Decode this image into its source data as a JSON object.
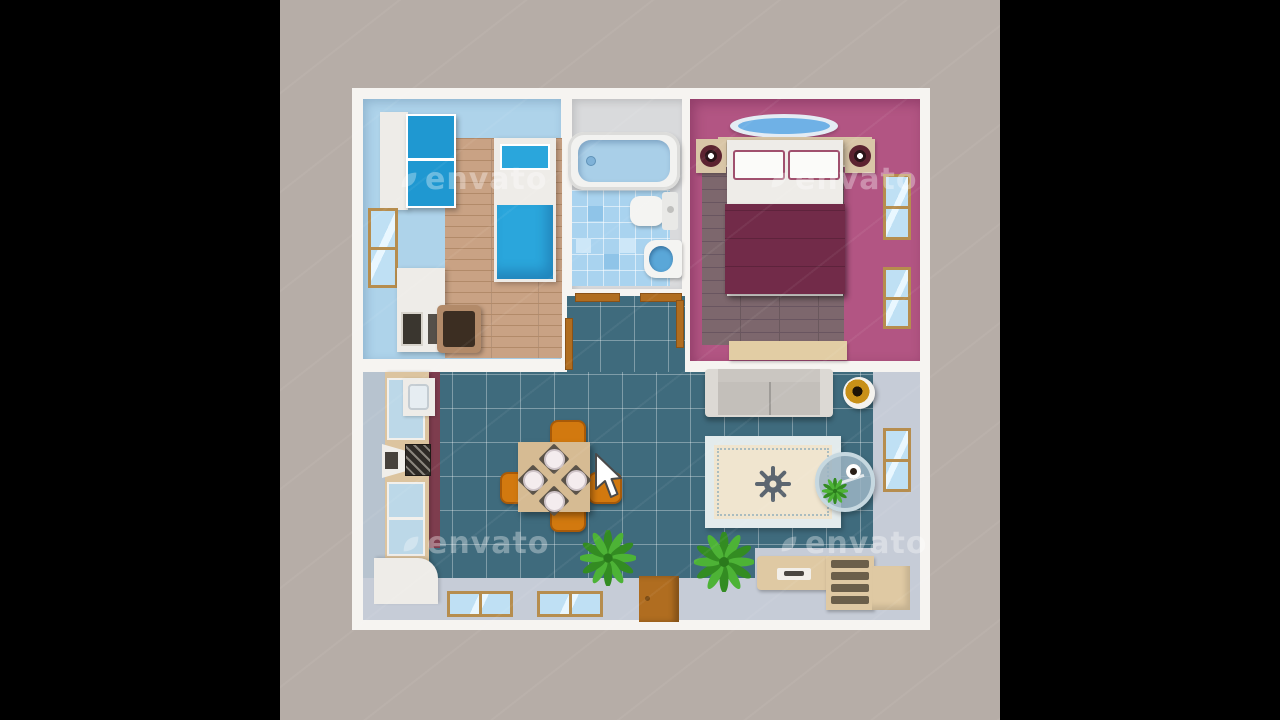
{
  "scene": {
    "type": "apartment-floor-plan-illustration",
    "watermark": {
      "text": "envato"
    }
  },
  "colors": {
    "letterbox": "#000000",
    "canvas_bg": "#b6ada7",
    "plan_frame": "#f6f4f1",
    "office_wall": "#aed3ea",
    "wood_floor": "#c9a284",
    "wood_line": "#b28a69",
    "cabinet_blue": "#1f98d1",
    "bed_blue": "#2aa6dc",
    "furniture_white": "#eeece8",
    "bath_wall": "#d9dadc",
    "bath_tile": "#a9d3ef",
    "bath_tile_dark": "#8fc4e8",
    "bath_tile_light": "#cde7f8",
    "water_blue": "#a9cfe8",
    "bedroom_wall": "#b25583",
    "bedroom_floor": "#7d676d",
    "bedroom_floor_line": "#695560",
    "blanket_maroon": "#722b49",
    "pillow_trim": "#a0506e",
    "headboard_tan": "#d9c6a7",
    "bench_tan": "#e2cda4",
    "speaker_ring": "#5c2330",
    "speaker_dark": "#2a1418",
    "lamp_blue": "#6fb1e6",
    "lamp_base": "#e4ecf4",
    "living_teal": "#3f6b7d",
    "hall_gray": "#c6ccd7",
    "wall_gray": "#b7c3cf",
    "counter_tan": "#dcc49f",
    "backsplash_maroon": "#7e3d4e",
    "cabinet_glass": "#bcd8e8",
    "stove_dark": "#2e2a26",
    "table_tan": "#d6bb93",
    "chair_orange": "#d2790f",
    "chair_border": "#a85a08",
    "sofa_gray": "#c3bfba",
    "sofa_light": "#dcd9d4",
    "rug_border": "#e3ebec",
    "rug_field": "#f0e5cf",
    "rug_medallion": "#5c6670",
    "plant_green": "#4db336",
    "plant_dark": "#338c22",
    "door_brown": "#b06d20",
    "door_dark": "#8a5217",
    "window_frame": "#b68d4e",
    "window_glass": "#bfe0f4",
    "rack_tan": "#dfc9a3",
    "slot_dark": "#6b5f4a",
    "lamp_gold": "#c89018",
    "glass_table": "#9bb4c2",
    "watermark": "rgba(255,255,255,0.34)"
  }
}
